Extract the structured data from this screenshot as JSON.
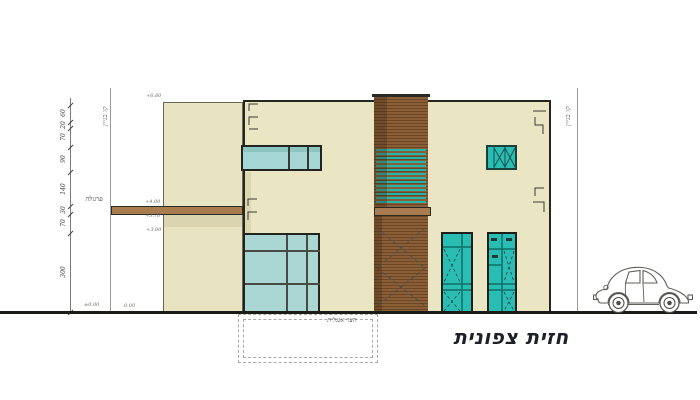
{
  "title": "חזית צפונית",
  "annotations": {
    "pergola_label": "פרגולה",
    "courtyard_label": "חצר אנגלית",
    "building_line_left": "קו בניין",
    "building_line_right": "קו בניין"
  },
  "dimensions": {
    "values": [
      "60",
      "20",
      "70",
      "90",
      "140",
      "30",
      "70",
      "300"
    ]
  },
  "elevation_markers": {
    "roof": "+6.80",
    "pergola_top": "+4.00",
    "pergola_bottom": "+3.70",
    "floor": "+3.00",
    "ground_left": "±0.00",
    "ground_right": "0.00"
  },
  "icons": {
    "car": "vw-beetle-car-icon",
    "gutter_marks": "downpipe-bracket-icon"
  },
  "colors": {
    "facade": "#eae5c3",
    "wood": "#8a5f38",
    "teal_glass": "#2abdb4",
    "light_glass": "#aad7d4",
    "pergola_beam": "#a87c4e",
    "ground": "#1c1c18"
  }
}
